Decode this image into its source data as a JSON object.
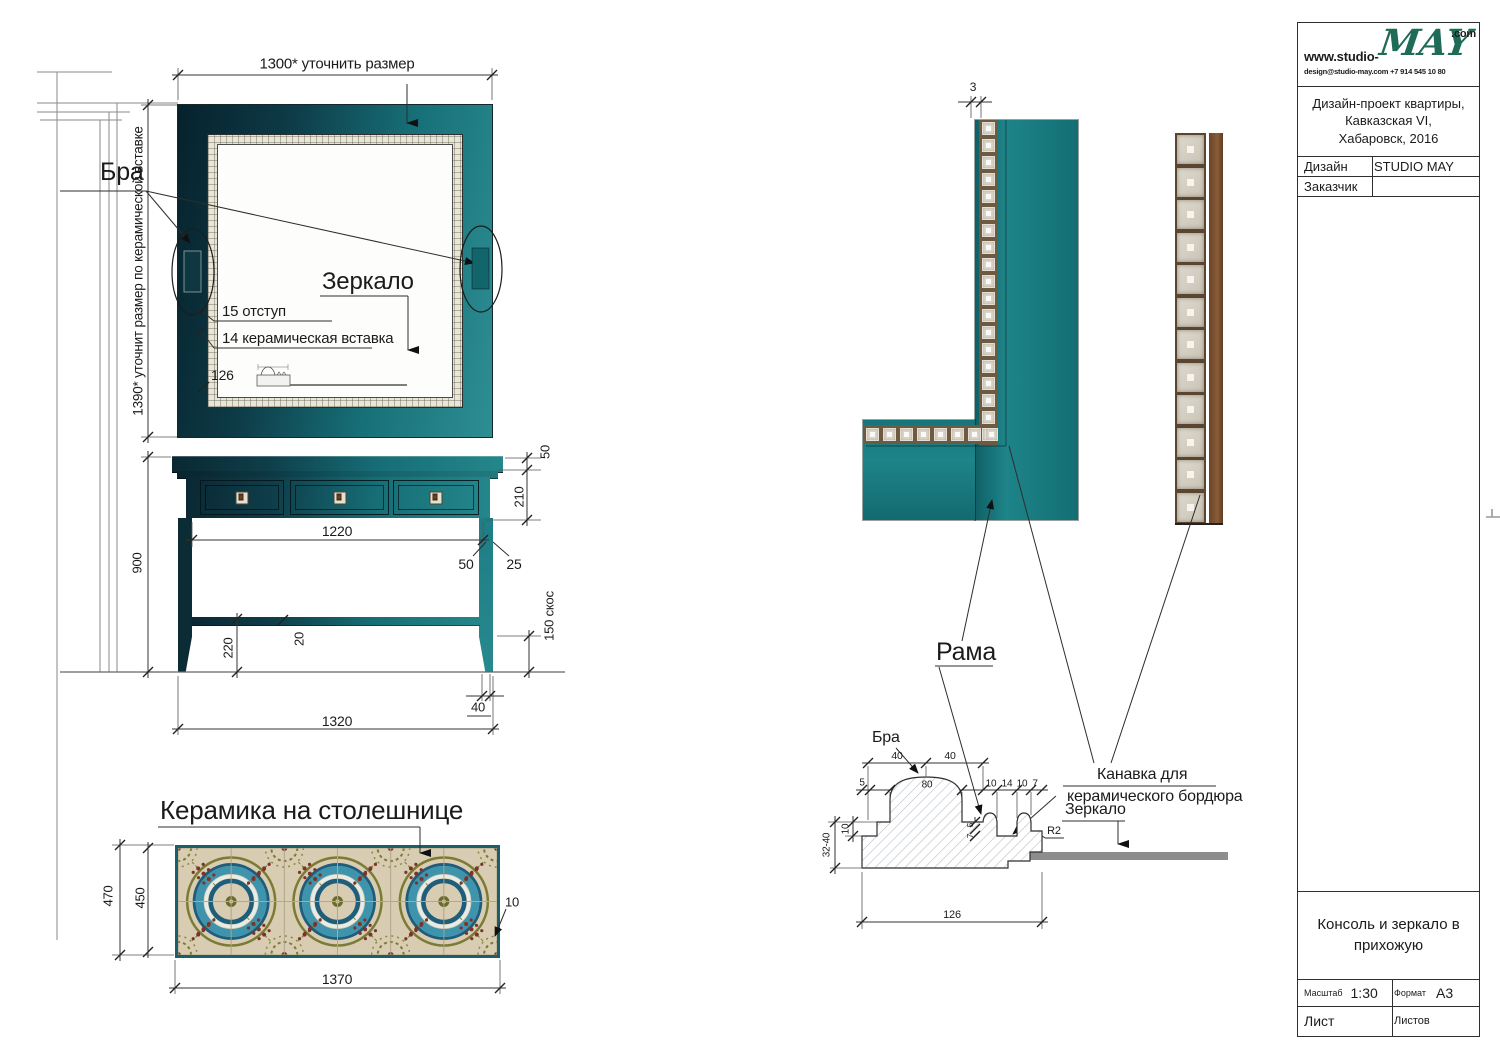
{
  "title_block": {
    "url_prefix": "www.studio-",
    "logo": "MAY",
    "tld": ".com",
    "contact": "design@studio-may.com  +7 914 545 10 80",
    "project": "Дизайн-проект квартиры,\nКавказская VI,\nХабаровск, 2016",
    "design_label": "Дизайн",
    "design_value": "STUDIO MAY",
    "client_label": "Заказчик",
    "client_value": "",
    "sheet_title": "Консоль и зеркало в прихожую",
    "scale_label": "Масштаб",
    "scale_value": "1:30",
    "format_label": "Формат",
    "format_value": "А3",
    "sheet_label": "Лист",
    "sheets_label": "Листов"
  },
  "labels": {
    "bra": "Бра",
    "zerkalo": "Зеркало",
    "offset15": "15 отступ",
    "insert14": "14 керамическая вставка",
    "frame126": "126",
    "keramika": "Керамика на столешнице",
    "rama": "Рама",
    "kanavka1": "Канавка для",
    "kanavka2": "керамического бордюра",
    "zerkalo2": "Зеркало",
    "bra2": "Бра"
  },
  "dims": {
    "mirror_w": "1300* уточнить размер",
    "mirror_h": "1390* уточнит размер по керамической вставке",
    "top50": "50",
    "drawer210": "210",
    "inner1220": "1220",
    "leg50": "50",
    "off25": "25",
    "h900": "900",
    "s220": "220",
    "t20": "20",
    "taper150": "150 скос",
    "w1320": "1320",
    "f40": "40",
    "th470": "470",
    "ti450": "450",
    "tw1370": "1370",
    "tt10": "10",
    "g3": "3",
    "a40": "40",
    "b40": "40",
    "p5": "5",
    "p80": "80",
    "p10a": "10",
    "p14": "14",
    "p10b": "10",
    "p7": "7",
    "v5": "5",
    "v7": "7",
    "r2": "R2",
    "n10": "10",
    "d3240": "32-40",
    "base126": "126"
  },
  "colors": {
    "frame_teal": "#1e8489",
    "frame_dark": "#0a2c36",
    "tile_blue": "#2e7291",
    "tile_beige": "#d8cdb2",
    "tile_olive": "#7b7b35",
    "tile_red": "#7c332b",
    "wood": "#7b5032",
    "logo_green": "#1e6b58",
    "mirror_gray": "#8d8d8d"
  },
  "pattern": {
    "ornament": {
      "cols": 6,
      "rows": 2
    },
    "border_vertical_tiles": 19,
    "border_horizontal_tiles": 8,
    "photo_tiles": 12
  }
}
